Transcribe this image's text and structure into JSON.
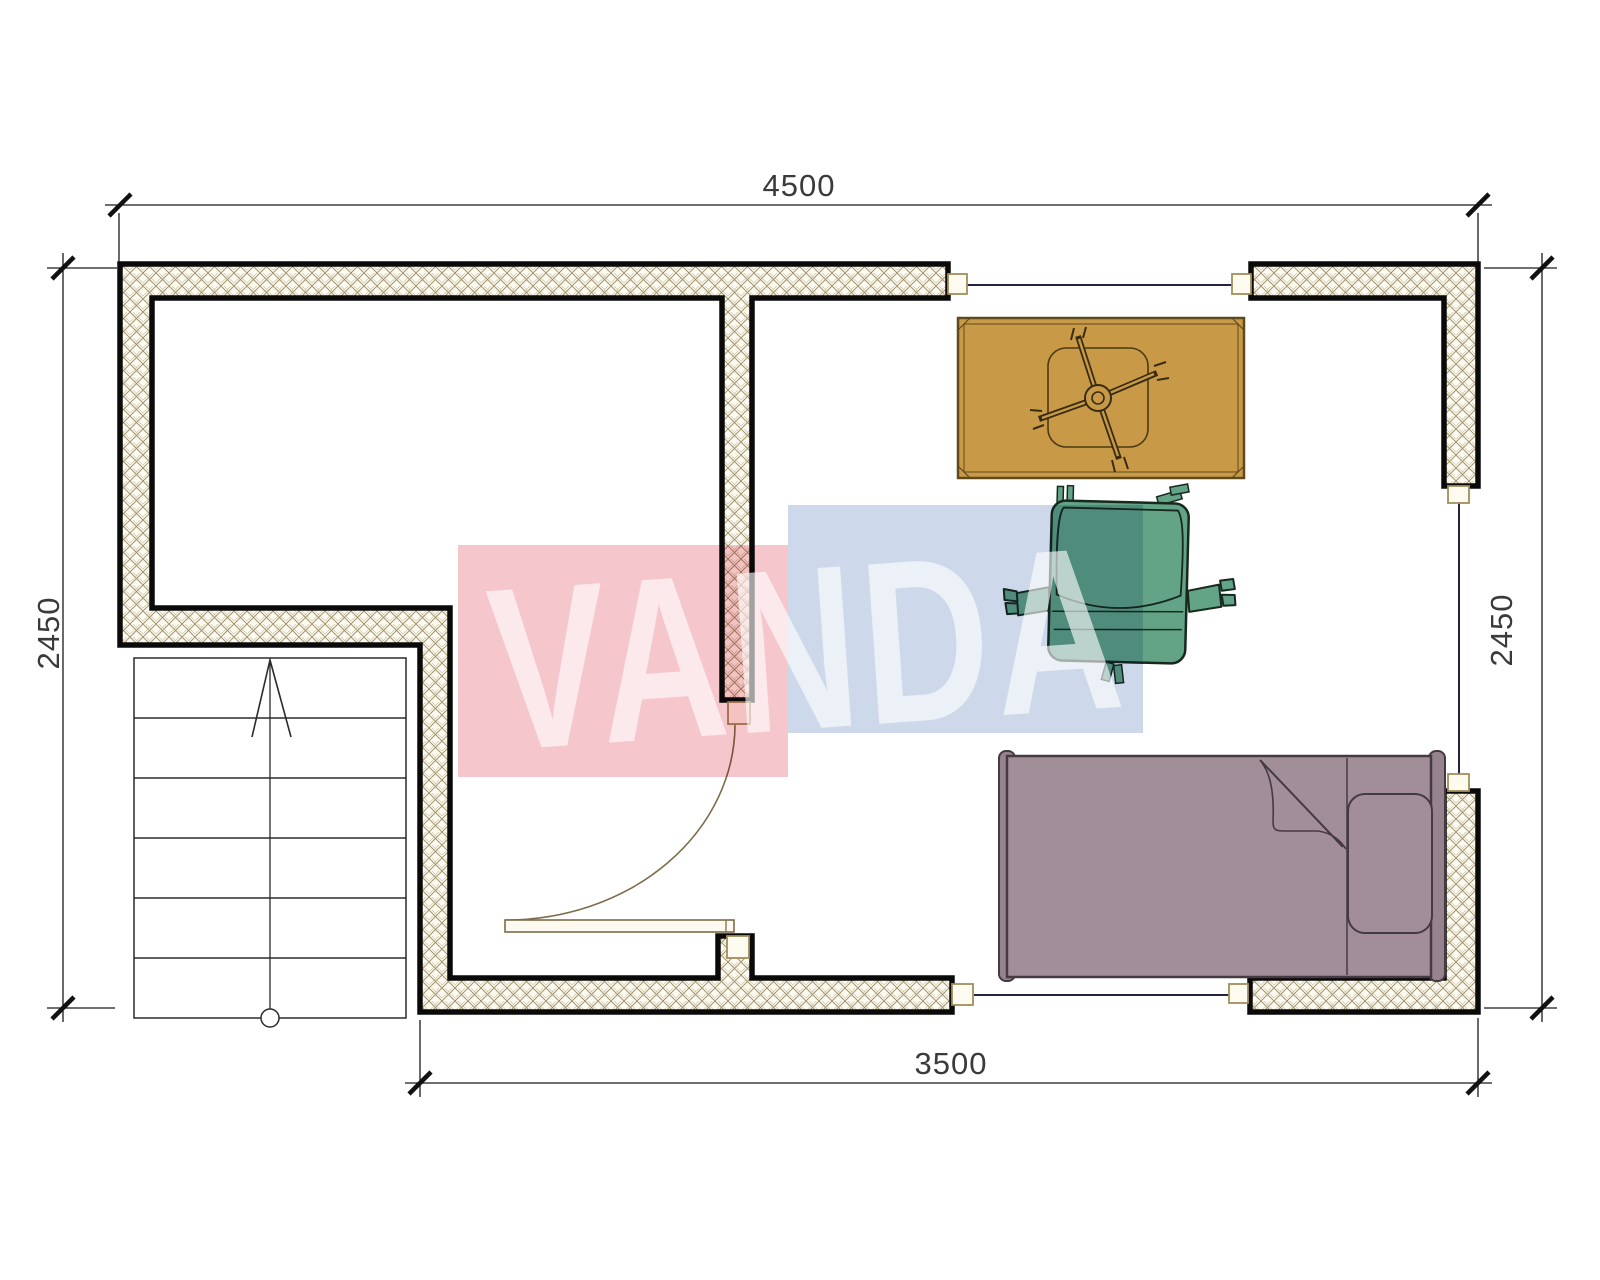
{
  "plan": {
    "title": "apartment-floor-plan",
    "dimensions": {
      "top": "4500",
      "bottom": "3500",
      "left": "2450",
      "right": "2450"
    },
    "watermark": {
      "text": "VANDA",
      "red_block_color": "#f6c6cd",
      "blue_block_color": "#cdd9ea",
      "text_color": "#ffffff"
    },
    "furniture": [
      {
        "name": "desk",
        "color": "#c89a47"
      },
      {
        "name": "office-chair-base",
        "color": "#3a2c12"
      },
      {
        "name": "armchair",
        "color": "#63a487"
      },
      {
        "name": "single-bed",
        "color": "#a28e99"
      },
      {
        "name": "staircase",
        "color": "#ffffff"
      }
    ],
    "symbols": {
      "wall_hatch_color": "#a2946f",
      "wall_border_color": "#0a0a0a",
      "window_line_color": "#23233f",
      "door_arc_color": "#7d6c49"
    }
  }
}
